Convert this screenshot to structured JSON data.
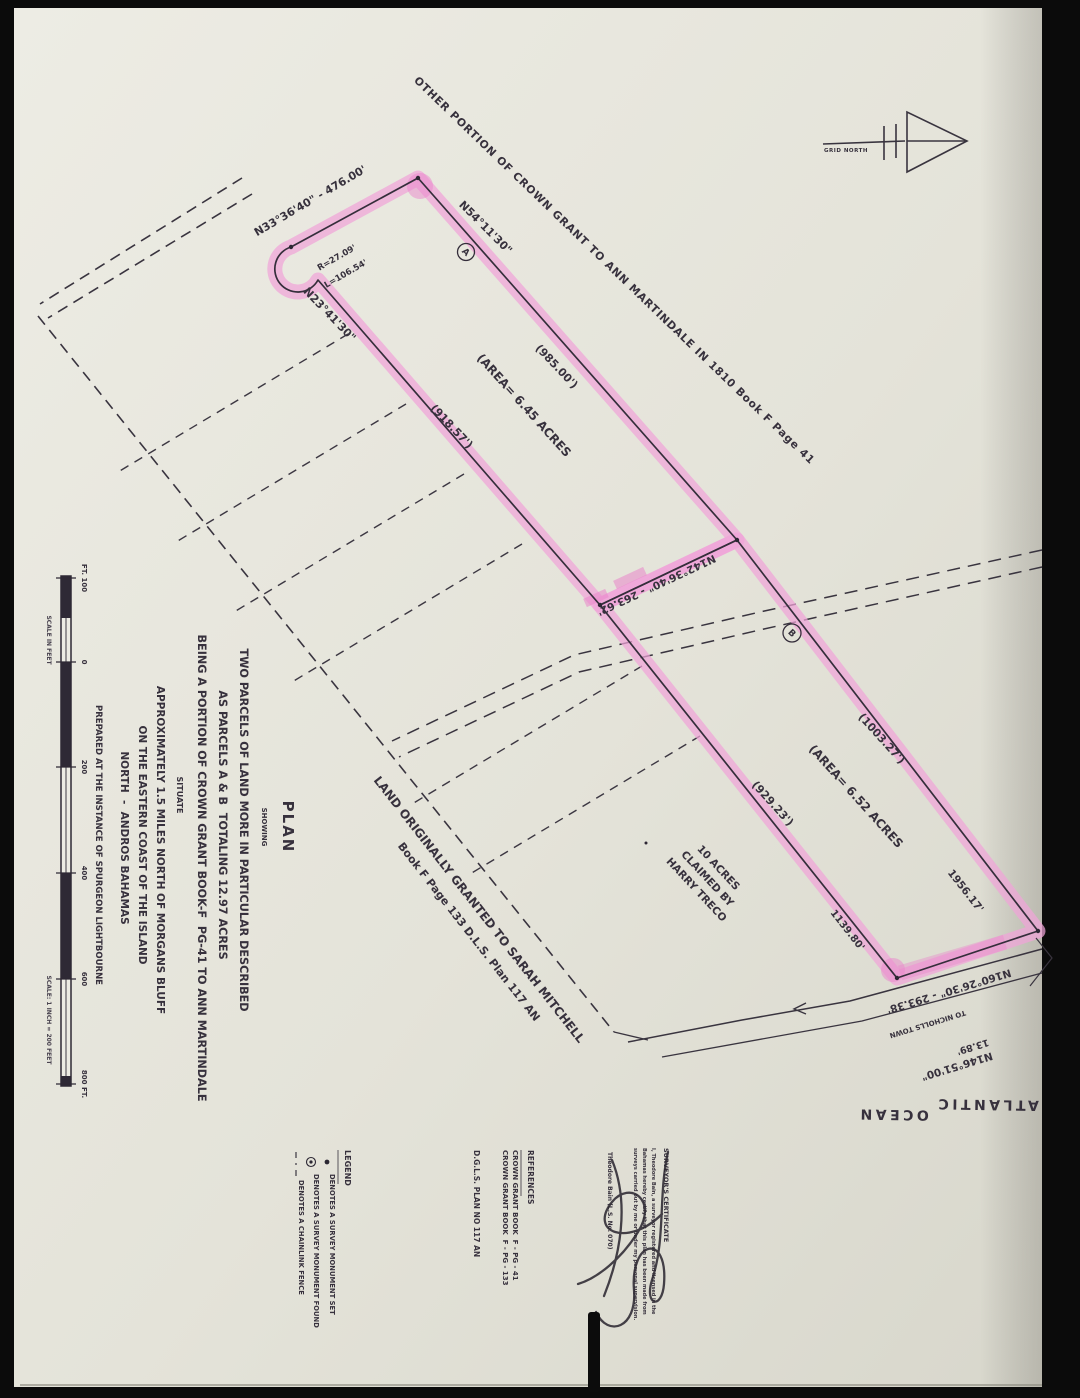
{
  "plan": {
    "north": {
      "label": "GRID NORTH"
    },
    "adjoiner_note": "OTHER PORTION OF CROWN GRANT TO ANN MARTINDALE IN 1810 Book F Page 41",
    "parcel_a": {
      "id": "A",
      "bearing_nw": "N33°36'40\" - 476.00'",
      "bearing_ne": "N54°11'30\"",
      "bearing_sw": "N23°41'30\"",
      "curve_radius": "R=27.09'",
      "curve_length": "L=106.54'",
      "length_ne": "(985.00')",
      "length_sw": "(918.57')",
      "area": "(AREA= 6.45 ACRES"
    },
    "division_bearing": "N142°36'40\" - 263.62'",
    "parcel_b": {
      "id": "B",
      "length_ne": "(1003.27')",
      "length_sw": "(929.23')",
      "area": "(AREA= 6.52 ACRES",
      "east_boundary_length": "1956.17'",
      "south_length": "1139.80'"
    },
    "claim_note": {
      "line1": "10 ACRES",
      "line2": "CLAIMED BY",
      "line3": "HARRY TRECO"
    },
    "mitchell_note": {
      "line1": "LAND ORIGINALLY GRANTED TO SARAH MITCHELL",
      "line2": "Book F Page 133 D.L.S. Plan 117 AN"
    },
    "road": {
      "bearing": "N160°26'30\" - 293.38'",
      "destination": "TO NICHOLLS TOWN",
      "offset": "13.89'",
      "bearing2": "N146°51'00\""
    },
    "ocean": {
      "word1": "ATLANTIC",
      "word2": "OCEAN"
    }
  },
  "scale_bar": {
    "caption_top": "SCALE IN FEET",
    "caption_bottom": "SCALE: 1 INCH = 200 FEET",
    "ticks": [
      "FT. 100",
      "0",
      "200",
      "400",
      "600",
      "800 FT."
    ]
  },
  "title_block": {
    "title": "PLAN",
    "showing": "SHOWING",
    "line1": "TWO PARCELS OF LAND MORE IN PARTICULAR DESCRIBED",
    "line2": "AS PARCELS A & B  TOTALING 12.97 ACRES",
    "line3": "BEING A PORTION OF CROWN GRANT BOOK-F  PG-41 TO ANN MARTINDALE",
    "line4": "SITUATE",
    "line5": "APPROXIMATELY 1.5 MILES NORTH OF MORGANS BLUFF",
    "line6": "ON THE EASTERN COAST OF THE ISLAND",
    "line7": "NORTH  -  ANDROS BAHAMAS",
    "line8": "PREPARED AT THE INSTANCE OF SPURGEON LIGHTBOURNE"
  },
  "legend": {
    "header": "LEGEND",
    "item1": "DENOTES A SURVEY MONUMENT SET",
    "item2": "DENOTES A SURVEY MONUMENT FOUND",
    "item3": "DENOTES A CHAINLINK FENCE"
  },
  "references": {
    "header": "REFERENCES",
    "item1": "CROWN GRANT BOOK  F - PG - 41",
    "item2": "CROWN GRANT BOOK  F - PG - 133",
    "item3": "D.G.L.S. PLAN NO 117 AN"
  },
  "certificate": {
    "header": "SURVEYOR'S CERTIFICATE",
    "line1": "I, Theodore Bain, a surveyor registered and licensed in the",
    "line2": "Bahamas hereby certify that this plan has been made from",
    "line3": "surveys carried out by me or under my personal supervision.",
    "signed_name": "Theodore Bain (L.S. No. 070)"
  },
  "colors": {
    "highlight": "#ef9cd6",
    "ink": "#37313d",
    "paper": "#e6e5dc"
  }
}
